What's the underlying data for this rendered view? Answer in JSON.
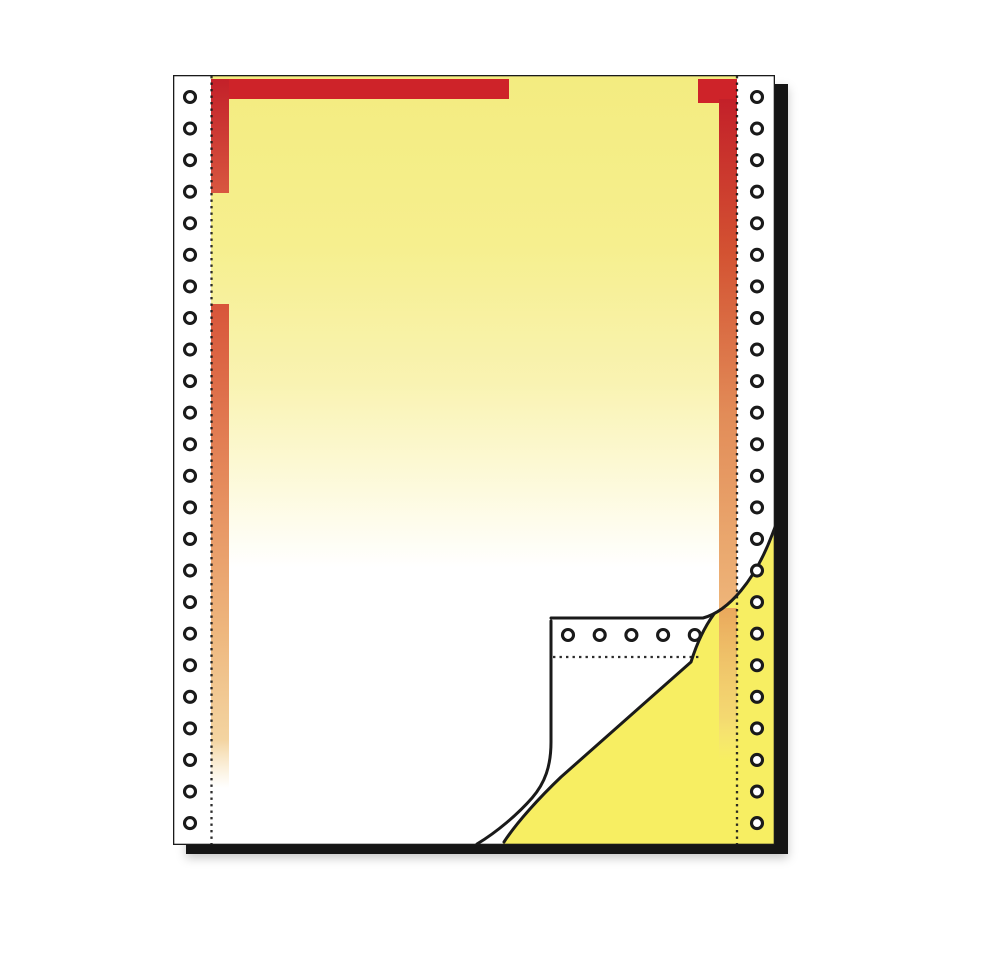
{
  "image": {
    "description": "Product image of continuous fanfold tractor-feed carbonless form paper. Top sheet has a yellow-to-white vertical gradient, a red header bar with a gap, red-to-orange fading side bars along both perforation lines, and white punched tractor margins. The bottom-right corner is curled back, revealing the bright-yellow copy sheet underneath (with its own punched margin and perforation) and the white underside of the curled corner showing a row of tractor holes above a fold perforation. The sheet stack has a thick black edge on the right and bottom.",
    "width_px": 1002,
    "height_px": 953
  },
  "colors": {
    "page-bg": "#ffffff",
    "line": "#1a1a1a",
    "edge-black": "#151515",
    "red": "#ce2329",
    "red-deep": "#c32029",
    "red-orange": "#d8553a",
    "orange": "#e28c58",
    "orange-pale": "#eeb579",
    "yellow-top": "#f3ec80",
    "yellow-mid": "#f9f3b2",
    "copy-yellow": "#f7ee62",
    "hole-fill": "#ffffff"
  },
  "paper": {
    "sheet": {
      "x": 173,
      "y": 75,
      "width": 602,
      "height": 770
    },
    "stack_edge": {
      "x": 186,
      "y": 84,
      "width": 602,
      "height": 770
    },
    "perforation_lines": [
      {
        "id": "perf-left",
        "x": 211.5,
        "y1": 76,
        "y2": 844
      },
      {
        "id": "perf-right",
        "x": 737,
        "y1": 76,
        "y2": 844
      }
    ],
    "fold_perforation": {
      "y": 657,
      "x1": 553,
      "x2": 699
    },
    "hole_columns": [
      {
        "id": "holes-left",
        "cx": 190,
        "start_y": 97,
        "spacing": 31.57,
        "count": 24,
        "radius": 5.5
      },
      {
        "id": "holes-right",
        "cx": 757,
        "start_y": 97,
        "spacing": 31.57,
        "count": 24,
        "radius": 5.5
      }
    ],
    "hole_row": {
      "id": "holes-flap",
      "cy": 635,
      "start_x": 568,
      "spacing": 31.7,
      "count": 5,
      "radius": 5.5
    }
  }
}
